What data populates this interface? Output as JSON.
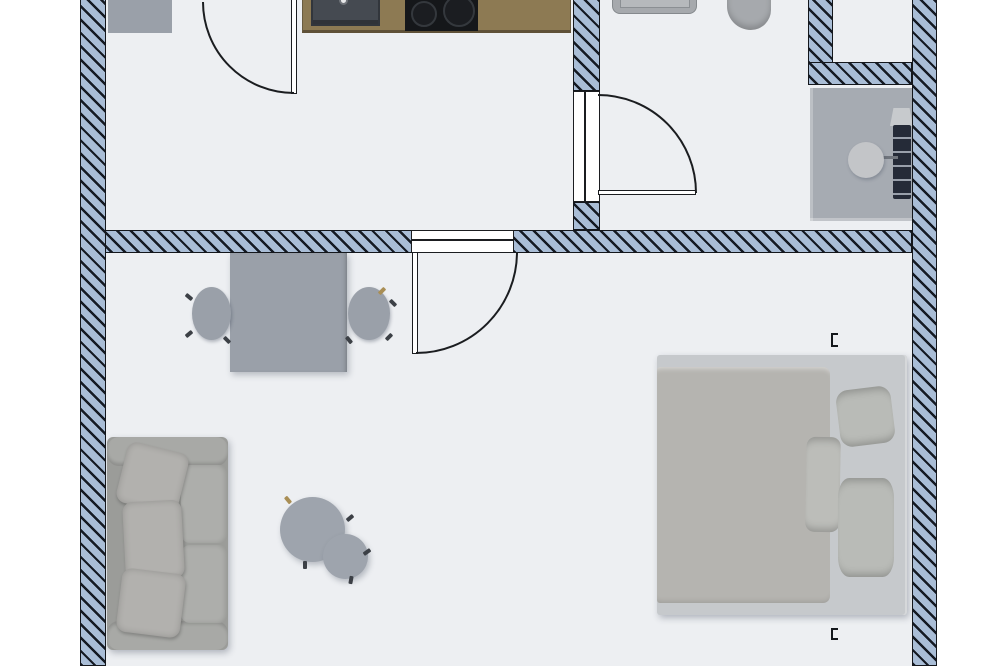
{
  "page": {
    "kind": "apartment-floor-plan-render",
    "view": "top-down",
    "visible_text": []
  },
  "colors": {
    "outside": "#ffffff",
    "floor": "#edeff2",
    "wall-fill": "#a9bdd6",
    "wall-stripe": "#151a23",
    "wall-edge": "#14171c",
    "door-line": "#1b1d20",
    "furniture-gray": "#9aa0a9",
    "round-table": "#9ea4ad",
    "sofa-body": "#9b9c99",
    "sofa-armrest": "#a8a9a6",
    "sofa-cushion": "#adaeab",
    "sofa-pillow": "#b2b1ae",
    "bed-base": "#c6c9cc",
    "bed-duvet": "#b5b4b0",
    "bed-pillow": "#b9bbb7",
    "wardrobe": "#9ca2ab",
    "counter-wood": "#8d7a53",
    "counter-edge": "#5f5138",
    "kitchen-sink": "#454a51",
    "cooktop": "#15171a",
    "burner-ring": "#34383d",
    "fixture": "#a6a9ad",
    "fixture-light": "#b6b9bc",
    "vanity": "#a6abb2",
    "stool": "#c3c5c8",
    "radiator": "#252b38",
    "radiator-stripe": "#99a0ab",
    "foot-dark": "#3c4046",
    "foot-tan": "#a98e55"
  },
  "rooms": [
    {
      "name": "kitchen",
      "furniture": [
        "wall-cabinet",
        "kitchen-counter",
        "kitchen-sink",
        "cooktop",
        "entry-door"
      ]
    },
    {
      "name": "bathroom",
      "furniture": [
        "washbasin",
        "toilet",
        "vanity-counter",
        "stool",
        "towel-radiator",
        "bathroom-door"
      ]
    },
    {
      "name": "utility-niche",
      "furniture": []
    },
    {
      "name": "living-room",
      "furniture": [
        "dining-table",
        "dining-chair-left",
        "dining-chair-right",
        "living-room-door",
        "sofa",
        "coffee-table-large",
        "coffee-table-small",
        "double-bed",
        "wardrobe-upper",
        "wardrobe-lower"
      ]
    }
  ],
  "doors": [
    {
      "name": "entry-door",
      "type": "hinged",
      "swing_deg": 90
    },
    {
      "name": "bathroom-door",
      "type": "hinged",
      "swing_deg": 90
    },
    {
      "name": "living-room-door",
      "type": "hinged",
      "swing_deg": 90
    }
  ],
  "walls": {
    "style": "diagonal-hatch",
    "count_segments": 8
  }
}
